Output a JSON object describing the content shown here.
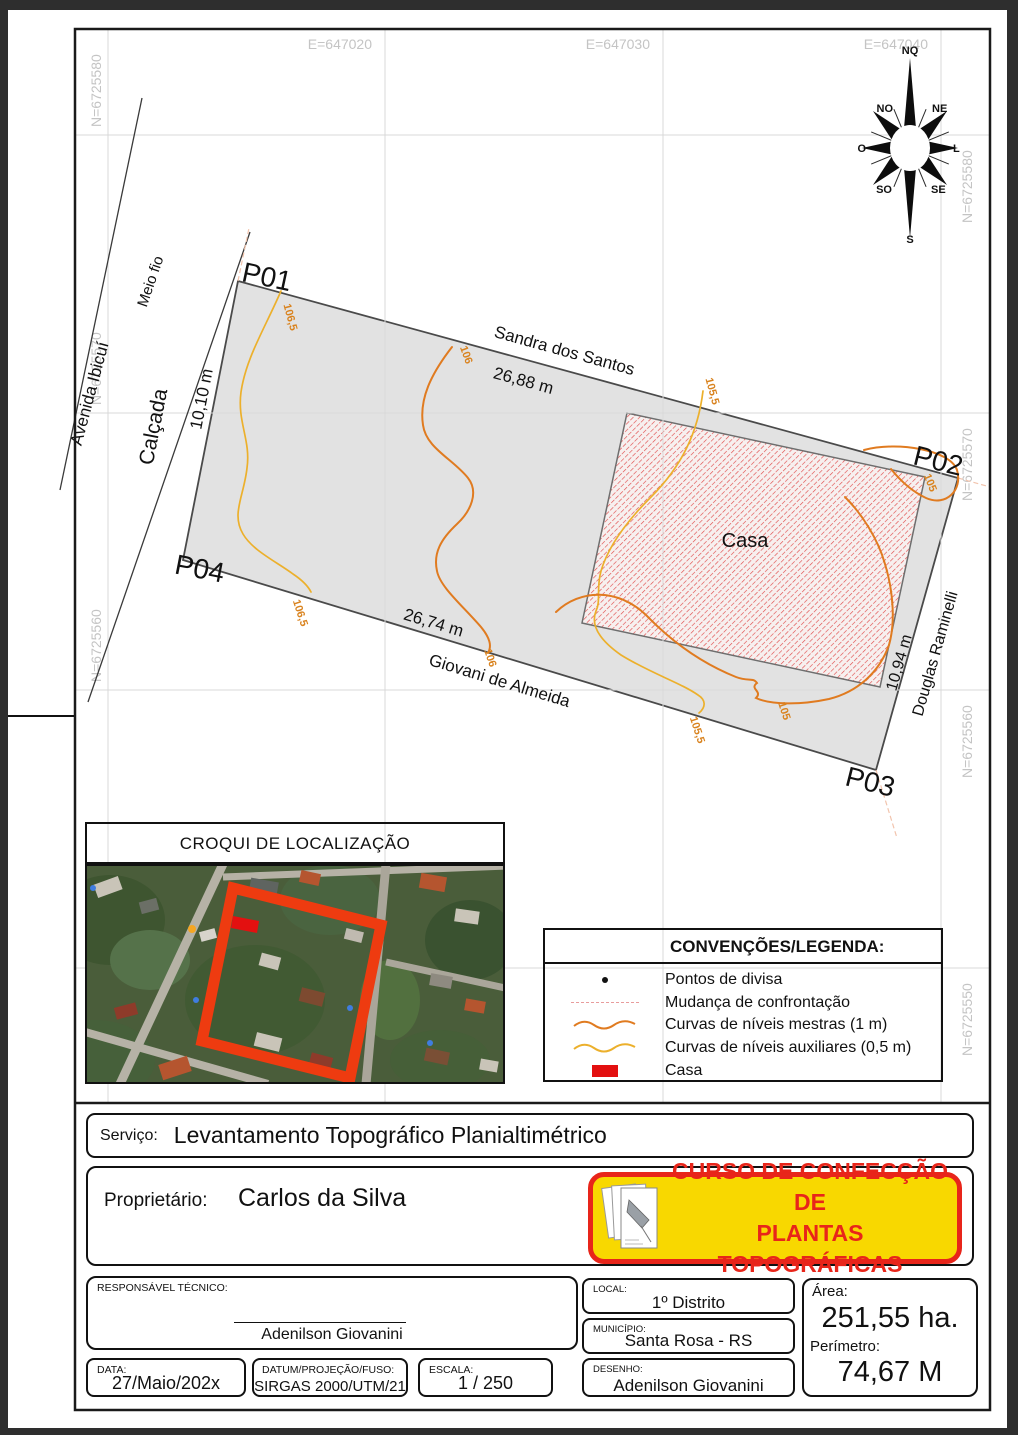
{
  "map": {
    "easting_labels": [
      "E=647020",
      "E=647030",
      "E=647040"
    ],
    "northing_labels_left": [
      "N=6725580",
      "N=6725570",
      "N=6725560"
    ],
    "northing_labels_right": [
      "N=6725580",
      "N=6725570",
      "N=6725560",
      "N=6725550"
    ],
    "compass": {
      "n": "NQ",
      "ne": "NE",
      "e": "L",
      "se": "SE",
      "s": "S",
      "sw": "SO",
      "w": "O",
      "nw": "NO"
    },
    "points": {
      "p1": "P01",
      "p2": "P02",
      "p3": "P03",
      "p4": "P04"
    },
    "streets": {
      "avenida": "Avenida Ibicuí",
      "meio_fio": "Meio fio",
      "calcada": "Calçada",
      "left_dim": "10,10 m",
      "top_street": "Sandra dos Santos",
      "top_dim": "26,88 m",
      "bottom_street": "Giovani de Almeida",
      "bottom_dim": "26,74 m",
      "right_street": "Douglas Raminelli",
      "right_dim": "10,94 m"
    },
    "contour_labels": {
      "c1065_top": "106,5",
      "c1065_bottom": "106,5",
      "c106_top": "106",
      "c106_bottom": "106",
      "c1055_top": "105,5",
      "c1055_bottom": "105,5",
      "c105_hook": "105",
      "c105_bottom": "105"
    },
    "casa_label": "Casa"
  },
  "croqui": {
    "title": "CROQUI DE LOCALIZAÇÃO"
  },
  "legend": {
    "title": "CONVENÇÕES/LEGENDA:",
    "items": [
      {
        "symbol": "divisa-point-icon",
        "label": "Pontos de divisa"
      },
      {
        "symbol": "dashed-line-icon",
        "label": "Mudança de confrontação"
      },
      {
        "symbol": "master-contour-icon",
        "label": "Curvas de níveis mestras (1 m)"
      },
      {
        "symbol": "aux-contour-icon",
        "label": "Curvas de níveis auxiliares (0,5 m)"
      },
      {
        "symbol": "casa-swatch-icon",
        "label": "Casa"
      }
    ]
  },
  "titleblock": {
    "servico_label": "Serviço:",
    "servico_value": "Levantamento Topográfico Planialtimétrico",
    "proprietario_label": "Proprietário:",
    "proprietario_value": "Carlos da Silva",
    "banner_line1": "CURSO DE CONFECÇÃO DE",
    "banner_line2": "PLANTAS TOPOGRÁFICAS",
    "responsavel_label": "RESPONSÁVEL TÉCNICO:",
    "responsavel_value": "Adenilson Giovanini",
    "local_label": "LOCAL:",
    "local_value": "1º Distrito",
    "municipio_label": "MUNICÍPIO:",
    "municipio_value": "Santa Rosa - RS",
    "desenho_label": "DESENHO:",
    "desenho_value": "Adenilson Giovanini",
    "area_label": "Área:",
    "area_value": "251,55 ha.",
    "perimetro_label": "Perímetro:",
    "perimetro_value": "74,67 M",
    "data_label": "DATA:",
    "data_value": "27/Maio/202x",
    "datum_label": "DATUM/PROJEÇÃO/FUSO:",
    "datum_value": "SIRGAS 2000/UTM/21",
    "escala_label": "ESCALA:",
    "escala_value": "1 / 250"
  },
  "colors": {
    "master_contour": "#e07b20",
    "aux_contour": "#ecb02c",
    "casa_hatch_red": "#e04848",
    "casa_solid_red": "#e31010",
    "banner_yellow": "#f8d800",
    "banner_red": "#e8251a",
    "parcel_gray": "#e2e2e2",
    "grid_gray": "#d9d9d9"
  }
}
